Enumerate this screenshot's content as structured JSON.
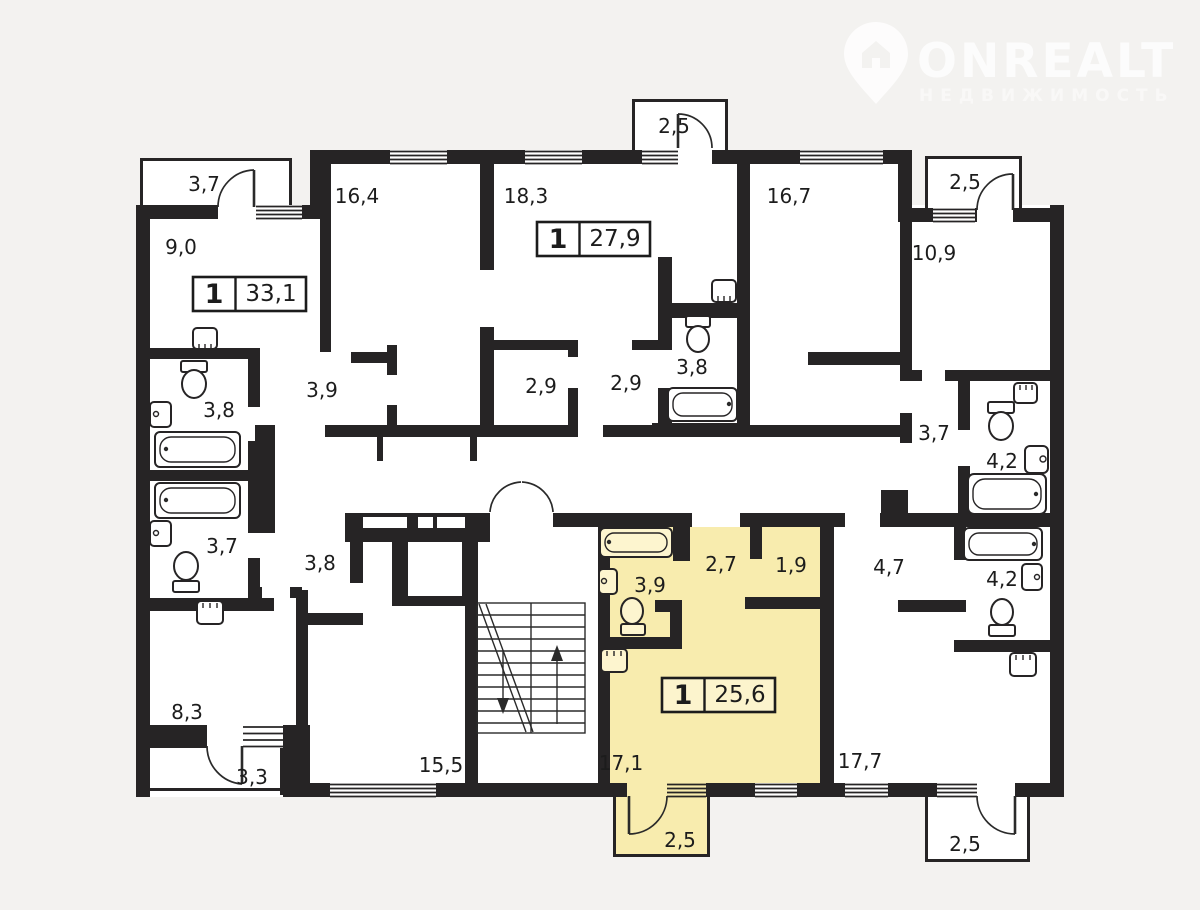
{
  "watermark": {
    "brand": "ONREALT",
    "subtitle": "НЕДВИЖИМОСТЬ"
  },
  "colors": {
    "background": "#f3f2f0",
    "walls": "#262425",
    "floor": "#ffffff",
    "highlight_apartment": "#f8ecae",
    "highlight_badge": "#fcf4cd",
    "label_text": "#1c1c1c"
  },
  "apartments": [
    {
      "id": "apt-33-1",
      "rooms": "1",
      "area": "33,1",
      "highlighted": false
    },
    {
      "id": "apt-27-9",
      "rooms": "1",
      "area": "27,9",
      "highlighted": false
    },
    {
      "id": "apt-25-6",
      "rooms": "1",
      "area": "25,6",
      "highlighted": true
    }
  ],
  "floor_plan": {
    "room_labels": [
      {
        "area": "3,7",
        "x": 204,
        "y": 191
      },
      {
        "area": "16,4",
        "x": 357,
        "y": 203
      },
      {
        "area": "18,3",
        "x": 526,
        "y": 203
      },
      {
        "area": "2,5",
        "x": 674,
        "y": 133
      },
      {
        "area": "16,7",
        "x": 789,
        "y": 203
      },
      {
        "area": "2,5",
        "x": 965,
        "y": 189
      },
      {
        "area": "9,0",
        "x": 181,
        "y": 254
      },
      {
        "area": "10,9",
        "x": 934,
        "y": 260
      },
      {
        "area": "3,9",
        "x": 322,
        "y": 397
      },
      {
        "area": "2,9",
        "x": 541,
        "y": 393
      },
      {
        "area": "2,9",
        "x": 626,
        "y": 390
      },
      {
        "area": "3,8",
        "x": 692,
        "y": 374
      },
      {
        "area": "3,8",
        "x": 219,
        "y": 417
      },
      {
        "area": "3,7",
        "x": 934,
        "y": 440
      },
      {
        "area": "4,2",
        "x": 1002,
        "y": 468
      },
      {
        "area": "3,7",
        "x": 222,
        "y": 553
      },
      {
        "area": "3,8",
        "x": 320,
        "y": 570
      },
      {
        "area": "3,9",
        "x": 650,
        "y": 592
      },
      {
        "area": "2,7",
        "x": 721,
        "y": 571
      },
      {
        "area": "1,9",
        "x": 791,
        "y": 572
      },
      {
        "area": "4,7",
        "x": 889,
        "y": 574
      },
      {
        "area": "4,2",
        "x": 1002,
        "y": 586
      },
      {
        "area": "8,3",
        "x": 187,
        "y": 719
      },
      {
        "area": "3,3",
        "x": 252,
        "y": 784
      },
      {
        "area": "15,5",
        "x": 441,
        "y": 772
      },
      {
        "area": "17,1",
        "x": 621,
        "y": 770
      },
      {
        "area": "17,7",
        "x": 860,
        "y": 768
      },
      {
        "area": "2,5",
        "x": 680,
        "y": 847
      },
      {
        "area": "2,5",
        "x": 965,
        "y": 851
      }
    ]
  }
}
